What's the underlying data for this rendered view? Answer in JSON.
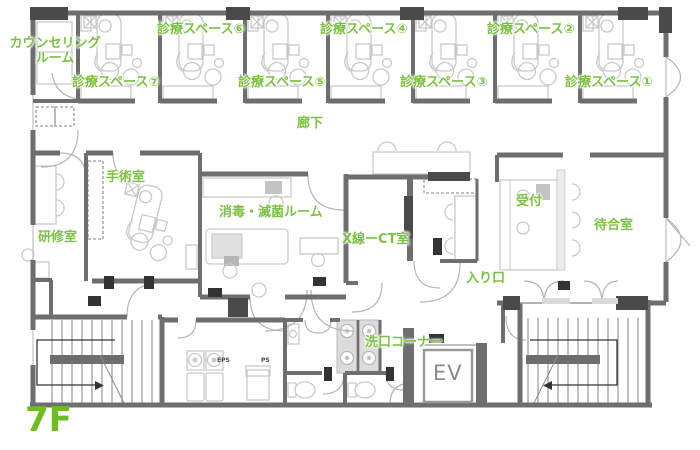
{
  "floor_plan": {
    "floor_label": "7F",
    "rooms": {
      "counseling": "カウンセリング\nルーム",
      "space7": "診療スペース⑦",
      "space6": "診療スペース⑥",
      "space5": "診療スペース⑤",
      "space4": "診療スペース④",
      "space3": "診療スペース③",
      "space2": "診療スペース②",
      "space1": "診療スペース①",
      "corridor": "廊下",
      "operating": "手術室",
      "sterilization": "消毒・滅菌ルーム",
      "xray_ct": "X線ーCT室",
      "reception": "受付",
      "waiting": "待合室",
      "training": "研修室",
      "entrance": "入り口",
      "rinse_corner": "洗口コーナー",
      "elevator": "EV",
      "eps": "EPS",
      "ps": "PS"
    },
    "colors": {
      "label_green": "#7cc142",
      "floor_green": "#6fbe20",
      "wall_gray": "#6e6e6e",
      "wall_dark": "#4a4a4a",
      "marker_dark": "#333333",
      "furniture_gray": "#c9c9c9",
      "fill_light": "#dcdcdc"
    }
  }
}
